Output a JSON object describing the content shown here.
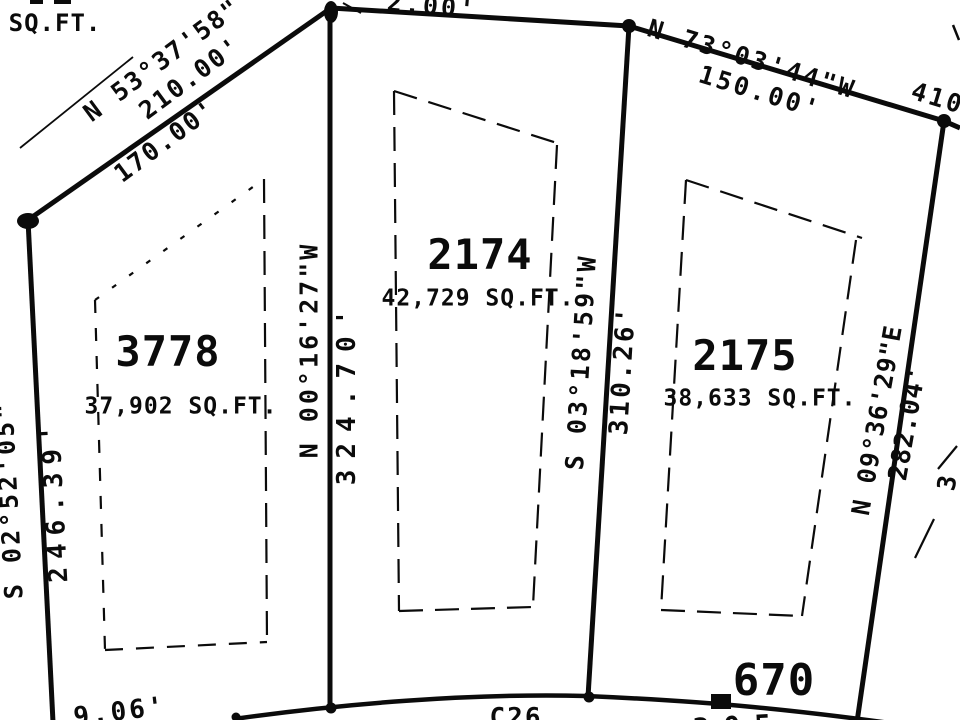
{
  "colors": {
    "background": "#ffffff",
    "ink": "#0b0b0b"
  },
  "lots": [
    {
      "number": "3778",
      "area": "37,902 SQ.FT."
    },
    {
      "number": "2174",
      "area": "42,729 SQ.FT."
    },
    {
      "number": "2175",
      "area": "38,633 SQ.FT."
    }
  ],
  "labels": {
    "corner_area_unit_fragment": "SQ.FT.",
    "nw_bearing": "N 53°37'58\"",
    "nw_distance_outer": "210.00'",
    "nw_distance_inner": "170.00'",
    "north_distance_fragment": "2.00'",
    "ne_bearing": "N 73°03'44\"W",
    "ne_distance": "150.00'",
    "east_distance_fragment": "410",
    "lot3778_east_bearing": "N 00°16'27\"W",
    "lot3778_east_distance": "324.70'",
    "lot2174_east_bearing": "S 03°18'59\"W",
    "lot2174_east_distance": "310.26'",
    "lot2175_east_bearing": "N 09°36'29\"E",
    "lot2175_east_distance": "282.04'",
    "west_bearing_fragment": "S 02°52'05\"",
    "west_distance": "246.39'",
    "south_distance_fragment": "9.06'",
    "curve_label": "C26",
    "south_number_fragment": "305",
    "east_edge_fragment": "3",
    "parcel_number_670": "670"
  }
}
